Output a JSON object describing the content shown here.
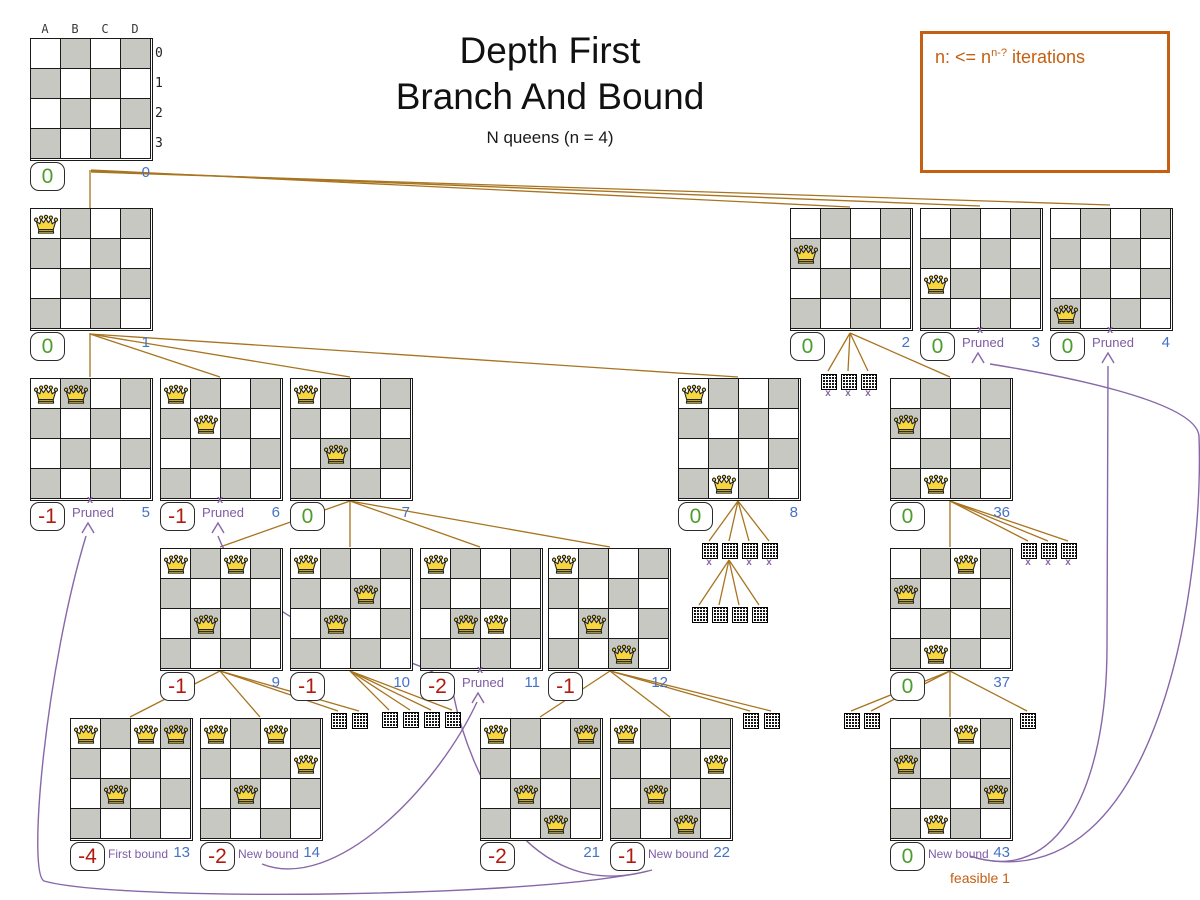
{
  "title": {
    "line1": "Depth First",
    "line2": "Branch And Bound",
    "subtitle": "N queens (n = 4)"
  },
  "note": {
    "prefix": "n: <= n",
    "sup": "n-?",
    "suffix": " iterations"
  },
  "labels": {
    "pruned": "Pruned"
  },
  "colors": {
    "edge": "#a8741f",
    "purple": "#8767a8",
    "purple_text": "#7d5ca3",
    "green": "#4e9c2d",
    "red": "#b11a0e",
    "blue": "#4472c4",
    "orange": "#c55f11",
    "cell_gray": "#c7c8c1"
  },
  "root_labels": {
    "cols": [
      "A",
      "B",
      "C",
      "D"
    ],
    "rows": [
      "0",
      "1",
      "2",
      "3"
    ]
  },
  "boards": [
    {
      "id": "0",
      "x": 30,
      "y": 38,
      "queens": [],
      "score": "0",
      "score_color": "green",
      "root": true
    },
    {
      "id": "1",
      "x": 30,
      "y": 208,
      "queens": [
        [
          0,
          0
        ]
      ],
      "score": "0",
      "score_color": "green"
    },
    {
      "id": "2",
      "x": 790,
      "y": 208,
      "queens": [
        [
          0,
          1
        ]
      ],
      "score": "0",
      "score_color": "green"
    },
    {
      "id": "3",
      "x": 920,
      "y": 208,
      "queens": [
        [
          0,
          2
        ]
      ],
      "score": "0",
      "score_color": "green",
      "pruned": true
    },
    {
      "id": "4",
      "x": 1050,
      "y": 208,
      "queens": [
        [
          0,
          3
        ]
      ],
      "score": "0",
      "score_color": "green",
      "pruned": true
    },
    {
      "id": "5",
      "x": 30,
      "y": 378,
      "queens": [
        [
          0,
          0
        ],
        [
          1,
          0
        ]
      ],
      "score": "-1",
      "score_color": "red",
      "pruned": true
    },
    {
      "id": "6",
      "x": 160,
      "y": 378,
      "queens": [
        [
          0,
          0
        ],
        [
          1,
          1
        ]
      ],
      "score": "-1",
      "score_color": "red",
      "pruned": true
    },
    {
      "id": "7",
      "x": 290,
      "y": 378,
      "queens": [
        [
          0,
          0
        ],
        [
          1,
          2
        ]
      ],
      "score": "0",
      "score_color": "green"
    },
    {
      "id": "8",
      "x": 678,
      "y": 378,
      "queens": [
        [
          0,
          0
        ],
        [
          1,
          3
        ]
      ],
      "score": "0",
      "score_color": "green"
    },
    {
      "id": "36",
      "x": 890,
      "y": 378,
      "queens": [
        [
          0,
          1
        ],
        [
          1,
          3
        ]
      ],
      "score": "0",
      "score_color": "green"
    },
    {
      "id": "9",
      "x": 160,
      "y": 548,
      "queens": [
        [
          0,
          0
        ],
        [
          2,
          0
        ],
        [
          1,
          2
        ]
      ],
      "score": "-1",
      "score_color": "red"
    },
    {
      "id": "10",
      "x": 290,
      "y": 548,
      "queens": [
        [
          0,
          0
        ],
        [
          2,
          1
        ],
        [
          1,
          2
        ]
      ],
      "score": "-1",
      "score_color": "red"
    },
    {
      "id": "11",
      "x": 420,
      "y": 548,
      "queens": [
        [
          0,
          0
        ],
        [
          1,
          2
        ],
        [
          2,
          2
        ]
      ],
      "score": "-2",
      "score_color": "red",
      "pruned": true
    },
    {
      "id": "12",
      "x": 548,
      "y": 548,
      "queens": [
        [
          0,
          0
        ],
        [
          1,
          2
        ],
        [
          2,
          3
        ]
      ],
      "score": "-1",
      "score_color": "red"
    },
    {
      "id": "37",
      "x": 890,
      "y": 548,
      "queens": [
        [
          2,
          0
        ],
        [
          0,
          1
        ],
        [
          1,
          3
        ]
      ],
      "score": "0",
      "score_color": "green"
    },
    {
      "id": "13",
      "x": 70,
      "y": 718,
      "queens": [
        [
          0,
          0
        ],
        [
          2,
          0
        ],
        [
          3,
          0
        ],
        [
          1,
          2
        ]
      ],
      "score": "-4",
      "score_color": "red",
      "bound": "First bound"
    },
    {
      "id": "14",
      "x": 200,
      "y": 718,
      "queens": [
        [
          0,
          0
        ],
        [
          2,
          0
        ],
        [
          3,
          1
        ],
        [
          1,
          2
        ]
      ],
      "score": "-2",
      "score_color": "red",
      "bound": "New bound"
    },
    {
      "id": "21",
      "x": 480,
      "y": 718,
      "queens": [
        [
          0,
          0
        ],
        [
          3,
          0
        ],
        [
          1,
          2
        ],
        [
          2,
          3
        ]
      ],
      "score": "-2",
      "score_color": "red"
    },
    {
      "id": "22",
      "x": 610,
      "y": 718,
      "queens": [
        [
          0,
          0
        ],
        [
          3,
          1
        ],
        [
          1,
          2
        ],
        [
          2,
          3
        ]
      ],
      "score": "-1",
      "score_color": "red",
      "bound": "New bound"
    },
    {
      "id": "43",
      "x": 890,
      "y": 718,
      "queens": [
        [
          2,
          0
        ],
        [
          0,
          1
        ],
        [
          3,
          2
        ],
        [
          1,
          3
        ]
      ],
      "score": "0",
      "score_color": "green",
      "bound": "New bound",
      "extra": "feasible 1"
    }
  ],
  "mini_grids": [
    {
      "x": 821,
      "y": 374,
      "pruned": true
    },
    {
      "x": 841,
      "y": 374,
      "pruned": true
    },
    {
      "x": 861,
      "y": 374,
      "pruned": true
    },
    {
      "x": 702,
      "y": 543,
      "pruned": true
    },
    {
      "x": 722,
      "y": 543,
      "pruned": false
    },
    {
      "x": 742,
      "y": 543,
      "pruned": true
    },
    {
      "x": 762,
      "y": 543,
      "pruned": true
    },
    {
      "x": 692,
      "y": 607,
      "pruned": false
    },
    {
      "x": 712,
      "y": 607,
      "pruned": false
    },
    {
      "x": 732,
      "y": 607,
      "pruned": false
    },
    {
      "x": 752,
      "y": 607,
      "pruned": false
    },
    {
      "x": 1021,
      "y": 543,
      "pruned": true
    },
    {
      "x": 1041,
      "y": 543,
      "pruned": true
    },
    {
      "x": 1061,
      "y": 543,
      "pruned": true
    },
    {
      "x": 331,
      "y": 713,
      "pruned": false
    },
    {
      "x": 352,
      "y": 713,
      "pruned": false
    },
    {
      "x": 382,
      "y": 712,
      "pruned": false
    },
    {
      "x": 403,
      "y": 712,
      "pruned": false
    },
    {
      "x": 424,
      "y": 712,
      "pruned": false
    },
    {
      "x": 445,
      "y": 712,
      "pruned": false
    },
    {
      "x": 743,
      "y": 713,
      "pruned": false
    },
    {
      "x": 764,
      "y": 713,
      "pruned": false
    },
    {
      "x": 844,
      "y": 713,
      "pruned": false
    },
    {
      "x": 864,
      "y": 713,
      "pruned": false
    },
    {
      "x": 1020,
      "y": 713,
      "pruned": false
    }
  ],
  "edges": [
    [
      90,
      170,
      90,
      208
    ],
    [
      91,
      170,
      850,
      207
    ],
    [
      91,
      171,
      980,
      206
    ],
    [
      91,
      172,
      1110,
      205
    ],
    [
      90,
      333,
      90,
      377
    ],
    [
      90,
      334,
      220,
      377
    ],
    [
      90,
      334,
      350,
      377
    ],
    [
      90,
      334,
      738,
      377
    ],
    [
      850,
      333,
      828,
      371
    ],
    [
      850,
      333,
      848,
      371
    ],
    [
      850,
      333,
      868,
      371
    ],
    [
      850,
      333,
      950,
      377
    ],
    [
      350,
      501,
      220,
      547
    ],
    [
      350,
      501,
      350,
      547
    ],
    [
      350,
      501,
      480,
      547
    ],
    [
      350,
      501,
      610,
      547
    ],
    [
      738,
      501,
      709,
      541
    ],
    [
      738,
      501,
      729,
      541
    ],
    [
      738,
      501,
      749,
      541
    ],
    [
      738,
      501,
      769,
      541
    ],
    [
      729,
      560,
      699,
      605
    ],
    [
      729,
      560,
      719,
      605
    ],
    [
      729,
      560,
      739,
      605
    ],
    [
      729,
      560,
      759,
      605
    ],
    [
      950,
      501,
      950,
      547
    ],
    [
      950,
      501,
      1028,
      541
    ],
    [
      950,
      501,
      1048,
      541
    ],
    [
      950,
      501,
      1068,
      541
    ],
    [
      220,
      671,
      130,
      717
    ],
    [
      220,
      671,
      260,
      717
    ],
    [
      220,
      671,
      338,
      711
    ],
    [
      220,
      671,
      359,
      711
    ],
    [
      350,
      671,
      389,
      710
    ],
    [
      350,
      671,
      410,
      710
    ],
    [
      350,
      671,
      431,
      710
    ],
    [
      350,
      671,
      452,
      710
    ],
    [
      610,
      671,
      540,
      717
    ],
    [
      610,
      671,
      670,
      717
    ],
    [
      610,
      671,
      750,
      711
    ],
    [
      610,
      671,
      771,
      711
    ],
    [
      950,
      671,
      851,
      711
    ],
    [
      950,
      671,
      871,
      711
    ],
    [
      950,
      671,
      950,
      717
    ],
    [
      950,
      671,
      1027,
      711
    ]
  ],
  "curves": [
    {
      "name": "new-bound-14-to-pruned-11",
      "d": "M 262,864 C 335,893 437,788 477,702"
    },
    {
      "name": "new-bound-22-to-pruned-5",
      "d": "M 652,870 C 545,898 118,902 44,881 C 27,872 46,668 86,536"
    },
    {
      "name": "new-bound-22-to-pruned-6",
      "d": "M 648,871 C 528,903 470,776 453,693 C 441,645 265,658 218,536"
    },
    {
      "name": "new-bound-43-to-pruned-4",
      "d": "M 970,856 C 1058,886 1107,788 1107,646 C 1107,530 1107,425 1108,366"
    },
    {
      "name": "new-bound-43-to-pruned-3",
      "d": "M 976,858 C 1160,900 1204,580 1199,436 C 1196,400 1052,374 990,364"
    }
  ]
}
